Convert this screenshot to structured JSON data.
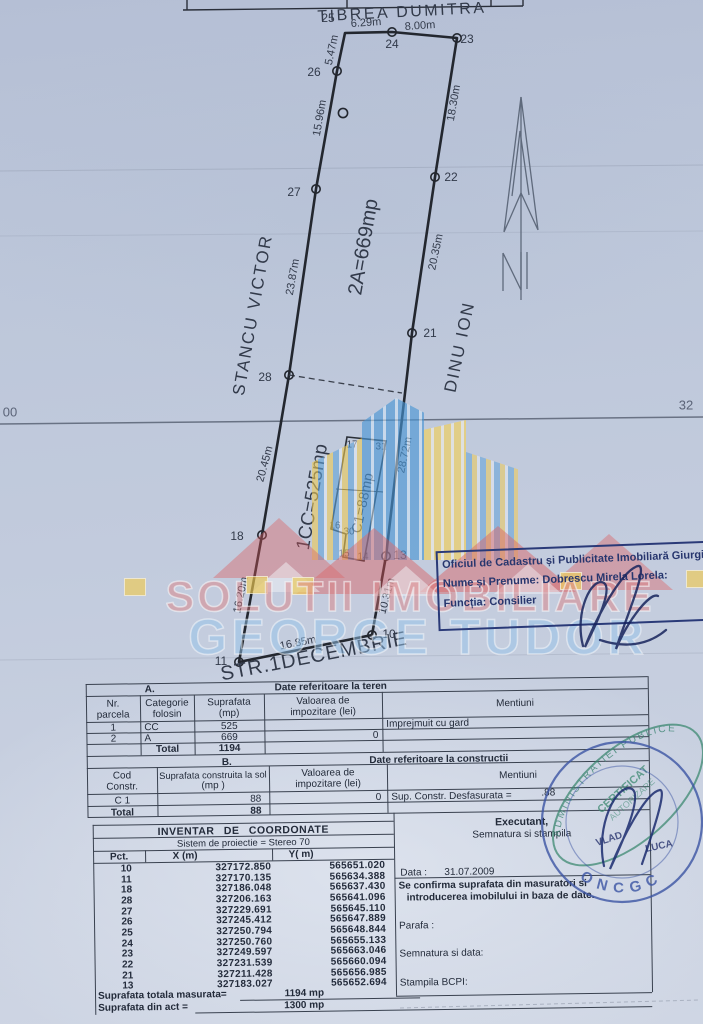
{
  "plot": {
    "owners": {
      "top": "TIBREA DUMITRA",
      "left": "STANCU VICTOR",
      "right": "DINU ION"
    },
    "street": "STR.1DECEMBRIE",
    "areas": {
      "a2": "2A=669mp",
      "cc": "1CC=525mp",
      "c1": "C1=88mp"
    },
    "grid": {
      "left": "00",
      "right": "32"
    },
    "pts": {
      "p10": "10",
      "p11": "11",
      "p13": "13",
      "p18": "18",
      "p21": "21",
      "p22": "22",
      "p23": "23",
      "p24": "24",
      "p25": "25",
      "p26": "26",
      "p27": "27",
      "p28": "28"
    },
    "bld": {
      "c14": "14",
      "c15": "15",
      "c16": "16",
      "c17": "17",
      "c30": "30",
      "c31": "31"
    },
    "m": {
      "m629": "6.29m",
      "m800": "8.00m",
      "m547": "5.47m",
      "m1596": "15.96m",
      "m2387": "23.87m",
      "m2045": "20.45m",
      "m1620": "16.20m",
      "m1685": "16.85m",
      "m1031": "10.31m",
      "m2872": "28.72m",
      "m2035": "20.35m",
      "m1830": "18.30m"
    }
  },
  "watermark": {
    "l1": "SOLUTII IMOBILIARE",
    "l2": "GEORGE TUDOR"
  },
  "oficiu": {
    "l1": "Oficiul de Cadastru și Publicitate Imobiliară Giurgiu",
    "l2": "Nume și Prenume: Dobrescu Mirela Lorela:",
    "l3": "Funcția: Consilier"
  },
  "table_a": {
    "sec": "A.",
    "title": "Date referitoare la teren",
    "h": {
      "nr1": "Nr.",
      "nr2": "parcela",
      "cat1": "Categorie",
      "cat2": "folosin",
      "sup1": "Suprafata",
      "sup2": "(mp)",
      "val1": "Valoarea de",
      "val2": "impozitare (lei)",
      "ment": "Mentiuni"
    },
    "rows": [
      [
        "1",
        "CC",
        "525",
        "",
        "Imprejmuit cu gard"
      ],
      [
        "2",
        "A",
        "669",
        "0",
        ""
      ]
    ],
    "total_label": "Total",
    "total": "1194"
  },
  "table_b": {
    "sec": "B.",
    "title": "Date referitoare la constructii",
    "h": {
      "cod1": "Cod",
      "cod2": "Constr.",
      "sup1": "Suprafata construita la sol",
      "sup2": "(mp )",
      "val1": "Valoarea de",
      "val2": "impozitare (lei)",
      "ment": "Mentiuni"
    },
    "row": {
      "cod": "C 1",
      "sup": "88",
      "val": "0",
      "ment": "Sup. Constr. Desfasurata =",
      "ment_val": ".88"
    },
    "total_label": "Total",
    "total": "88"
  },
  "coords": {
    "title": "INVENTAR DE COORDONATE",
    "proj": "Sistem de proiectie = Stereo 70",
    "h": {
      "pct": "Pct.",
      "x": "X (m)",
      "y": "Y( m)"
    },
    "rows": [
      [
        "10",
        "327172.850",
        "565651.020"
      ],
      [
        "11",
        "327170.135",
        "565634.388"
      ],
      [
        "18",
        "327186.048",
        "565637.430"
      ],
      [
        "28",
        "327206.163",
        "565641.096"
      ],
      [
        "27",
        "327229.691",
        "565645.110"
      ],
      [
        "26",
        "327245.412",
        "565647.889"
      ],
      [
        "25",
        "327250.794",
        "565648.844"
      ],
      [
        "24",
        "327250.760",
        "565655.133"
      ],
      [
        "23",
        "327249.597",
        "565663.046"
      ],
      [
        "22",
        "327231.539",
        "565660.094"
      ],
      [
        "21",
        "327211.428",
        "565656.985"
      ],
      [
        "13",
        "327183.027",
        "565652.694"
      ]
    ],
    "sum1_label": "Suprafata totala masurata=",
    "sum1_val": "1194 mp",
    "sum2_label": "Suprafata din act =",
    "sum2_val": "1300 mp"
  },
  "executant": {
    "t1": "Executant,",
    "t2": "Semnatura si stampila",
    "data_label": "Data :",
    "data_val": "31.07.2009",
    "c1": "Se confirma suprafata din masuratori si",
    "c2": "introducerea imobilului in baza de date.",
    "parafa": "Parafa :",
    "semnatura": "Semnatura si data:",
    "stampila": "Stampila BCPI:"
  },
  "stamps": {
    "cert": {
      "arc": "ADMINISTRATIEI PUBLICE",
      "l1": "CERTIFICAT",
      "l2": "AUTORIZARE"
    },
    "round": {
      "bottom": "ONCGC",
      "n1": "VLAD",
      "n2": "LUCA"
    }
  }
}
